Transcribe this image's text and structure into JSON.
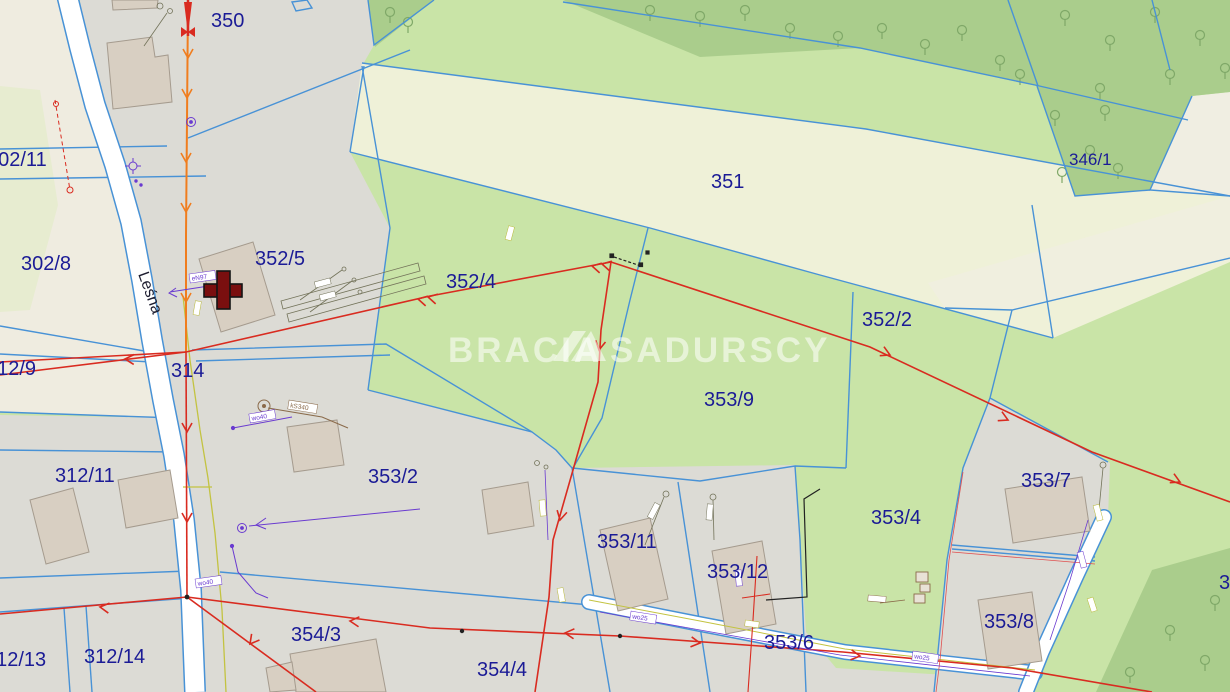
{
  "map": {
    "watermark": {
      "part1": "BRACIA",
      "part2": "SADURSCY"
    },
    "street": {
      "name": "Leśna"
    },
    "parcels": {
      "p350": "350",
      "p302_11": "302/11",
      "p302_8": "302/8",
      "p312_9": "312/9",
      "p314": "314",
      "p352_5": "352/5",
      "p352_4": "352/4",
      "p351": "351",
      "p346_1": "346/1",
      "p352_2": "352/2",
      "p353_9": "353/9",
      "p312_11": "312/11",
      "p353_2": "353/2",
      "p353_11": "353/11",
      "p353_12": "353/12",
      "p353_4": "353/4",
      "p353_7": "353/7",
      "p353_8": "353/8",
      "p353_6": "353/6",
      "p354_3": "354/3",
      "p354_4": "354/4",
      "p312_14": "312/14",
      "p312_13": "312/13",
      "p_right_clip": "3"
    },
    "utility_labels": {
      "u_eN97": "eN97",
      "u_wo40a": "wo40",
      "u_wo40b": "wo40",
      "u_kS340": "kS340",
      "u_wo25a": "wo25",
      "u_wo25b": "wo25"
    },
    "colors": {
      "parcel_line": "#4892d6",
      "meadow_green": "#c9e4a7",
      "forest_green": "#aacd8c",
      "field_cream": "#eff1d8",
      "built_grey": "#dcdbd5",
      "building": "#d8cfc2",
      "label_navy": "#1b1b96",
      "power_red": "#d92b20",
      "power_orange": "#f07d1e",
      "gas_yellow": "#c3c341",
      "telecom_purple": "#6a3bd0",
      "church_cross": "#7a0f0f"
    }
  }
}
